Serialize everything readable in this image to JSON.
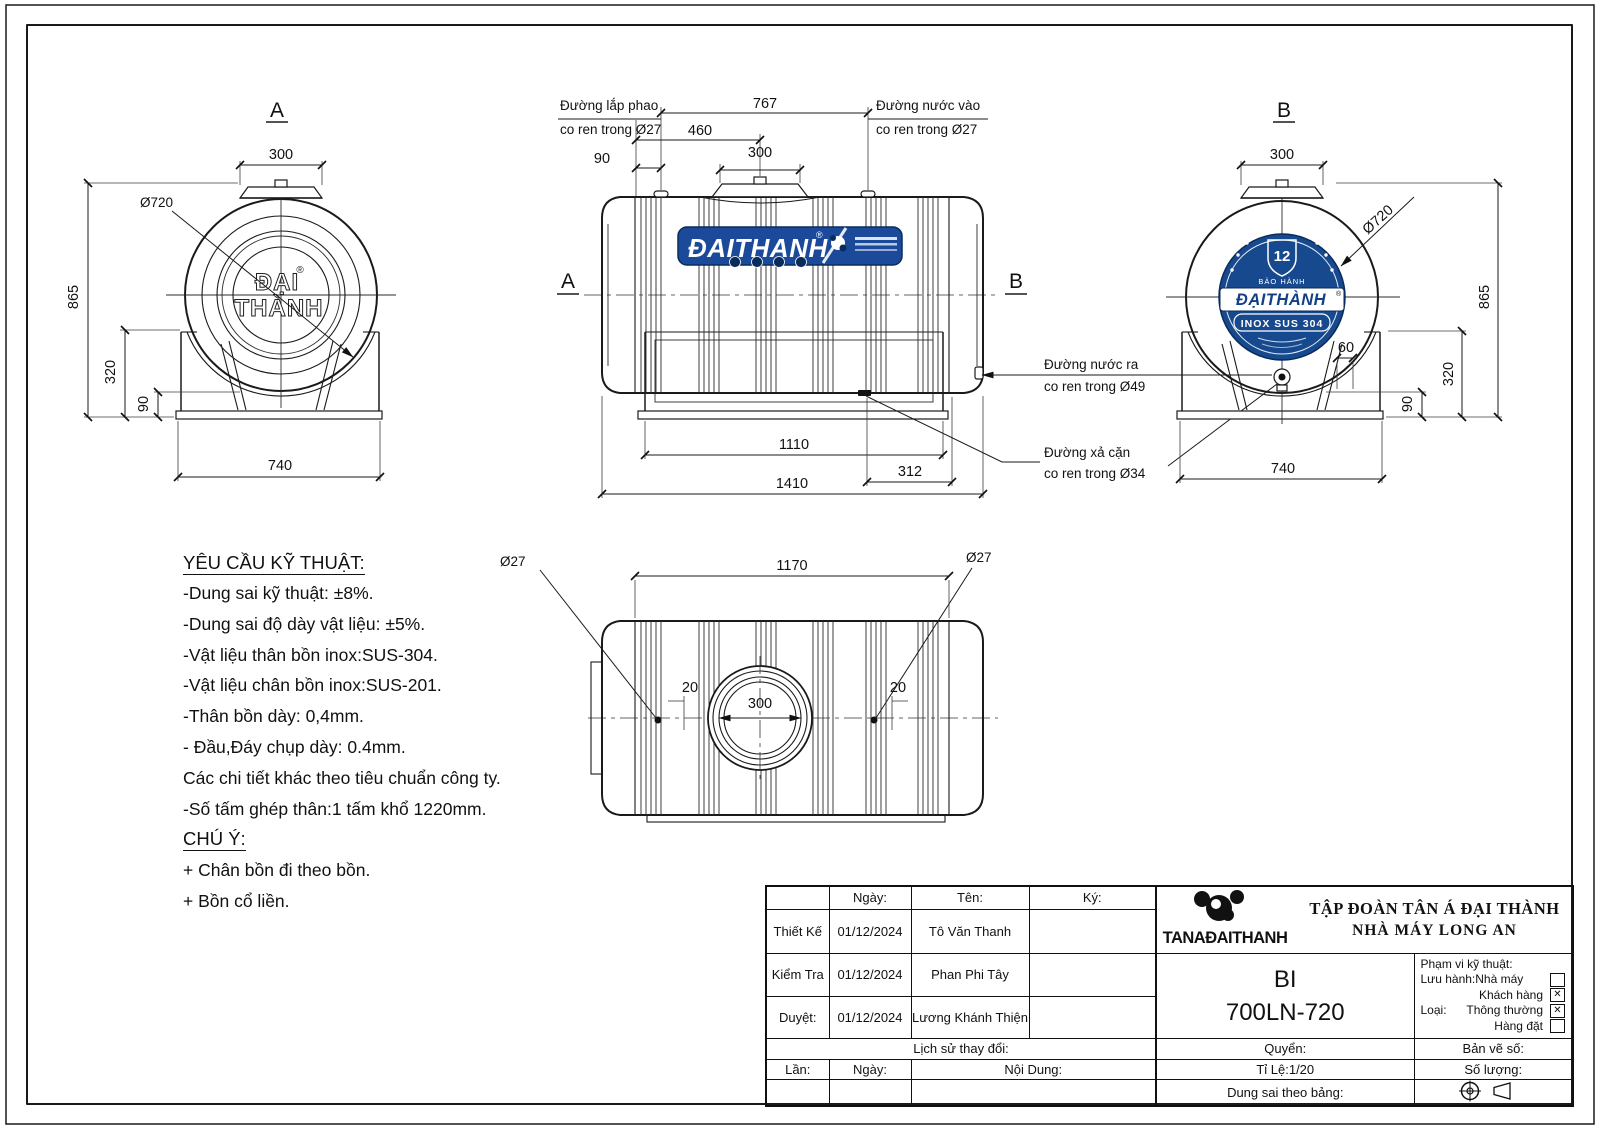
{
  "colors": {
    "brand_blue": "#1b4a9b",
    "badge_blue": "#17498f",
    "badge_dark": "#0a2c5c",
    "line": "#1a1a1a"
  },
  "views": {
    "front": {
      "label": "A",
      "dim_cap_width": "300",
      "dim_diameter": "Ø720",
      "dim_total_height": "865",
      "dim_stand_height": "320",
      "dim_base_height": "90",
      "dim_base_width": "740",
      "logo_line1": "ĐẠI",
      "logo_line2": "THÀNH",
      "logo_reg": "®"
    },
    "side": {
      "marker_left": "A",
      "marker_right": "B",
      "dim_fittings_span": "767",
      "dim_manhole_offset": "460",
      "dim_float_offset": "90",
      "dim_manhole_width": "300",
      "dim_stand_length": "1110",
      "dim_drain_offset": "312",
      "dim_total_length": "1410",
      "label_float_line1": "Đường lắp phao",
      "label_float_line2": "co ren trong Ø27",
      "label_inlet_line1": "Đường nước vào",
      "label_inlet_line2": "co ren trong Ø27",
      "label_outlet_line1": "Đường nước ra",
      "label_outlet_line2": "co ren trong Ø49",
      "label_drain_line1": "Đường xả cặn",
      "label_drain_line2": "co ren trong Ø34",
      "brand_text": "ĐAITHANH",
      "brand_reg": "®"
    },
    "rear": {
      "label": "B",
      "dim_cap_width": "300",
      "dim_diameter": "Ø720",
      "dim_total_height": "865",
      "dim_stand_height": "320",
      "dim_base_height": "90",
      "dim_drain_offset": "60",
      "dim_base_width": "740",
      "badge_number": "12",
      "badge_warranty": "BẢO HÀNH",
      "badge_brand": "ĐẠITHÀNH",
      "badge_reg": "®",
      "badge_material": "INOX SUS 304"
    },
    "top": {
      "dim_body_length": "1170",
      "dim_fitting_left": "Ø27",
      "dim_fitting_right": "Ø27",
      "dim_offset_left": "20",
      "dim_offset_right": "20",
      "dim_manhole": "300"
    }
  },
  "notes": {
    "title": "YÊU CẦU KỸ THUẬT:",
    "items": [
      "-Dung sai kỹ thuật: ±8%.",
      "-Dung sai độ dày vật liệu: ±5%.",
      "-Vật liệu thân bồn inox:SUS-304.",
      "-Vật liệu chân bồn inox:SUS-201.",
      "-Thân bồn dày: 0,4mm.",
      "- Đầu,Đáy chụp dày: 0.4mm.",
      "Các chi tiết khác theo tiêu chuẩn công ty.",
      "-Số tấm ghép thân:1 tấm khổ 1220mm."
    ],
    "note_title": "CHÚ Ý:",
    "note_items": [
      "+ Chân bồn đi theo bồn.",
      "+ Bồn cổ liền."
    ]
  },
  "titleblock": {
    "col_date": "Ngày:",
    "col_name": "Tên:",
    "col_sign": "Ký:",
    "rows": [
      {
        "role": "Thiết Kế",
        "date": "01/12/2024",
        "name": "Tô Văn Thanh"
      },
      {
        "role": "Kiểm Tra",
        "date": "01/12/2024",
        "name": "Phan Phi Tây"
      },
      {
        "role": "Duyệt:",
        "date": "01/12/2024",
        "name": "Lương Khánh Thiện"
      }
    ],
    "history": "Lịch sử thay đổi:",
    "rev": "Lần:",
    "rev_date": "Ngày:",
    "rev_content": "Nội Dung:",
    "company_line1": "TẬP ĐOÀN TÂN Á ĐẠI THÀNH",
    "company_line2": "NHÀ MÁY LONG AN",
    "logo_text": "TANAĐAITHANH",
    "product_code": "BI",
    "product_model": "700LN-720",
    "scope_title": "Phạm vi kỹ thuật:",
    "scope_rows": [
      {
        "prefix": "Lưu hành:",
        "label": "Nhà máy",
        "mark": ""
      },
      {
        "prefix": "",
        "label": "Khách hàng",
        "mark": "✕"
      },
      {
        "prefix": "Loại:",
        "label": "Thông thường",
        "mark": "✕"
      },
      {
        "prefix": "",
        "label": "Hàng đặt",
        "mark": ""
      }
    ],
    "book": "Quyển:",
    "drawing_no": "Bản vẽ số:",
    "scale": "Tỉ Lệ:1/20",
    "quantity": "Số lượng:",
    "tolerance": "Dung sai theo bảng:"
  }
}
